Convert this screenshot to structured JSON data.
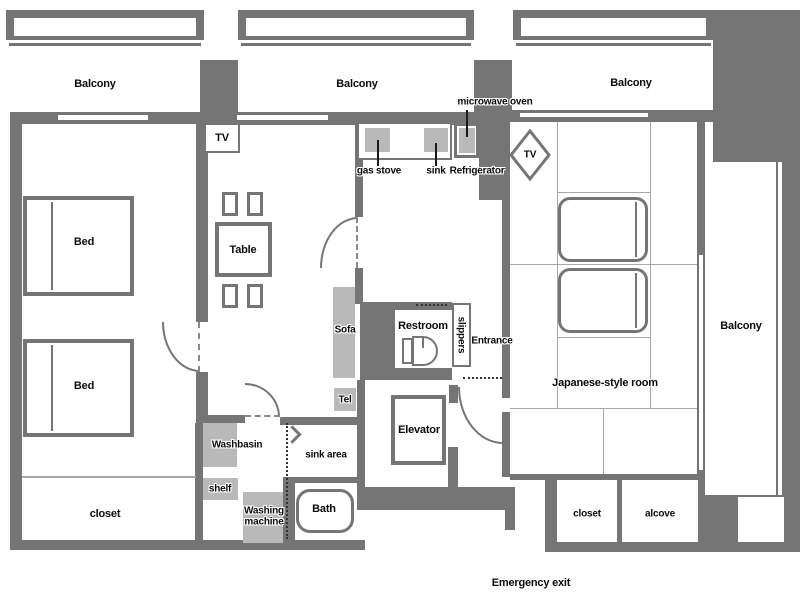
{
  "title": "Apartment floor plan",
  "colors": {
    "wall": "#757575",
    "fixture": "#b9b9b9",
    "tatami_line": "#a8a8a8"
  },
  "labels": {
    "balcony_top_left": "Balcony",
    "balcony_top_mid": "Balcony",
    "balcony_top_right": "Balcony",
    "balcony_right": "Balcony",
    "tv_living": "TV",
    "tv_japanese": "TV",
    "bed_upper": "Bed",
    "bed_lower": "Bed",
    "closet_bedroom": "closet",
    "table": "Table",
    "sofa": "Sofa",
    "tel": "Tel",
    "gas_stove": "gas stove",
    "sink": "sink",
    "refrigerator": "Refrigerator",
    "microwave_oven": "microwave oven",
    "restroom": "Restroom",
    "slippers": "slippers",
    "entrance": "Entrance",
    "elevator": "Elevator",
    "washbasin": "Washbasin",
    "shelf": "shelf",
    "sink_area": "sink area",
    "washing_machine": "Washing machine",
    "bath": "Bath",
    "japanese_room": "Japanese-style room",
    "closet_japanese": "closet",
    "alcove": "alcove",
    "emergency_exit": "Emergency exit"
  }
}
